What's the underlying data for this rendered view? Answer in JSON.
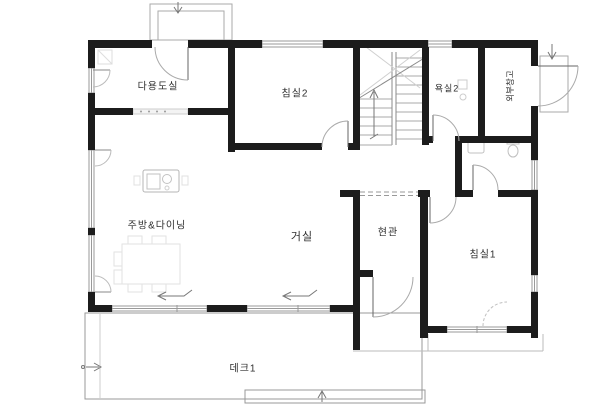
{
  "rooms": [
    {
      "id": "utility",
      "label": "다용도실"
    },
    {
      "id": "bedroom2",
      "label": "침실2"
    },
    {
      "id": "bath2",
      "label": "욕실2"
    },
    {
      "id": "storage",
      "label": "외부창고"
    },
    {
      "id": "kitchen",
      "label": "주방&다이닝"
    },
    {
      "id": "living",
      "label": "거실"
    },
    {
      "id": "entry",
      "label": "현관"
    },
    {
      "id": "bedroom1",
      "label": "침실1"
    },
    {
      "id": "deck",
      "label": "데크1"
    }
  ],
  "colors": {
    "wall": "#1c1c1c",
    "line": "#999999",
    "faint": "#d5d5d5",
    "text": "#2e2e2e",
    "background": "#ffffff"
  }
}
